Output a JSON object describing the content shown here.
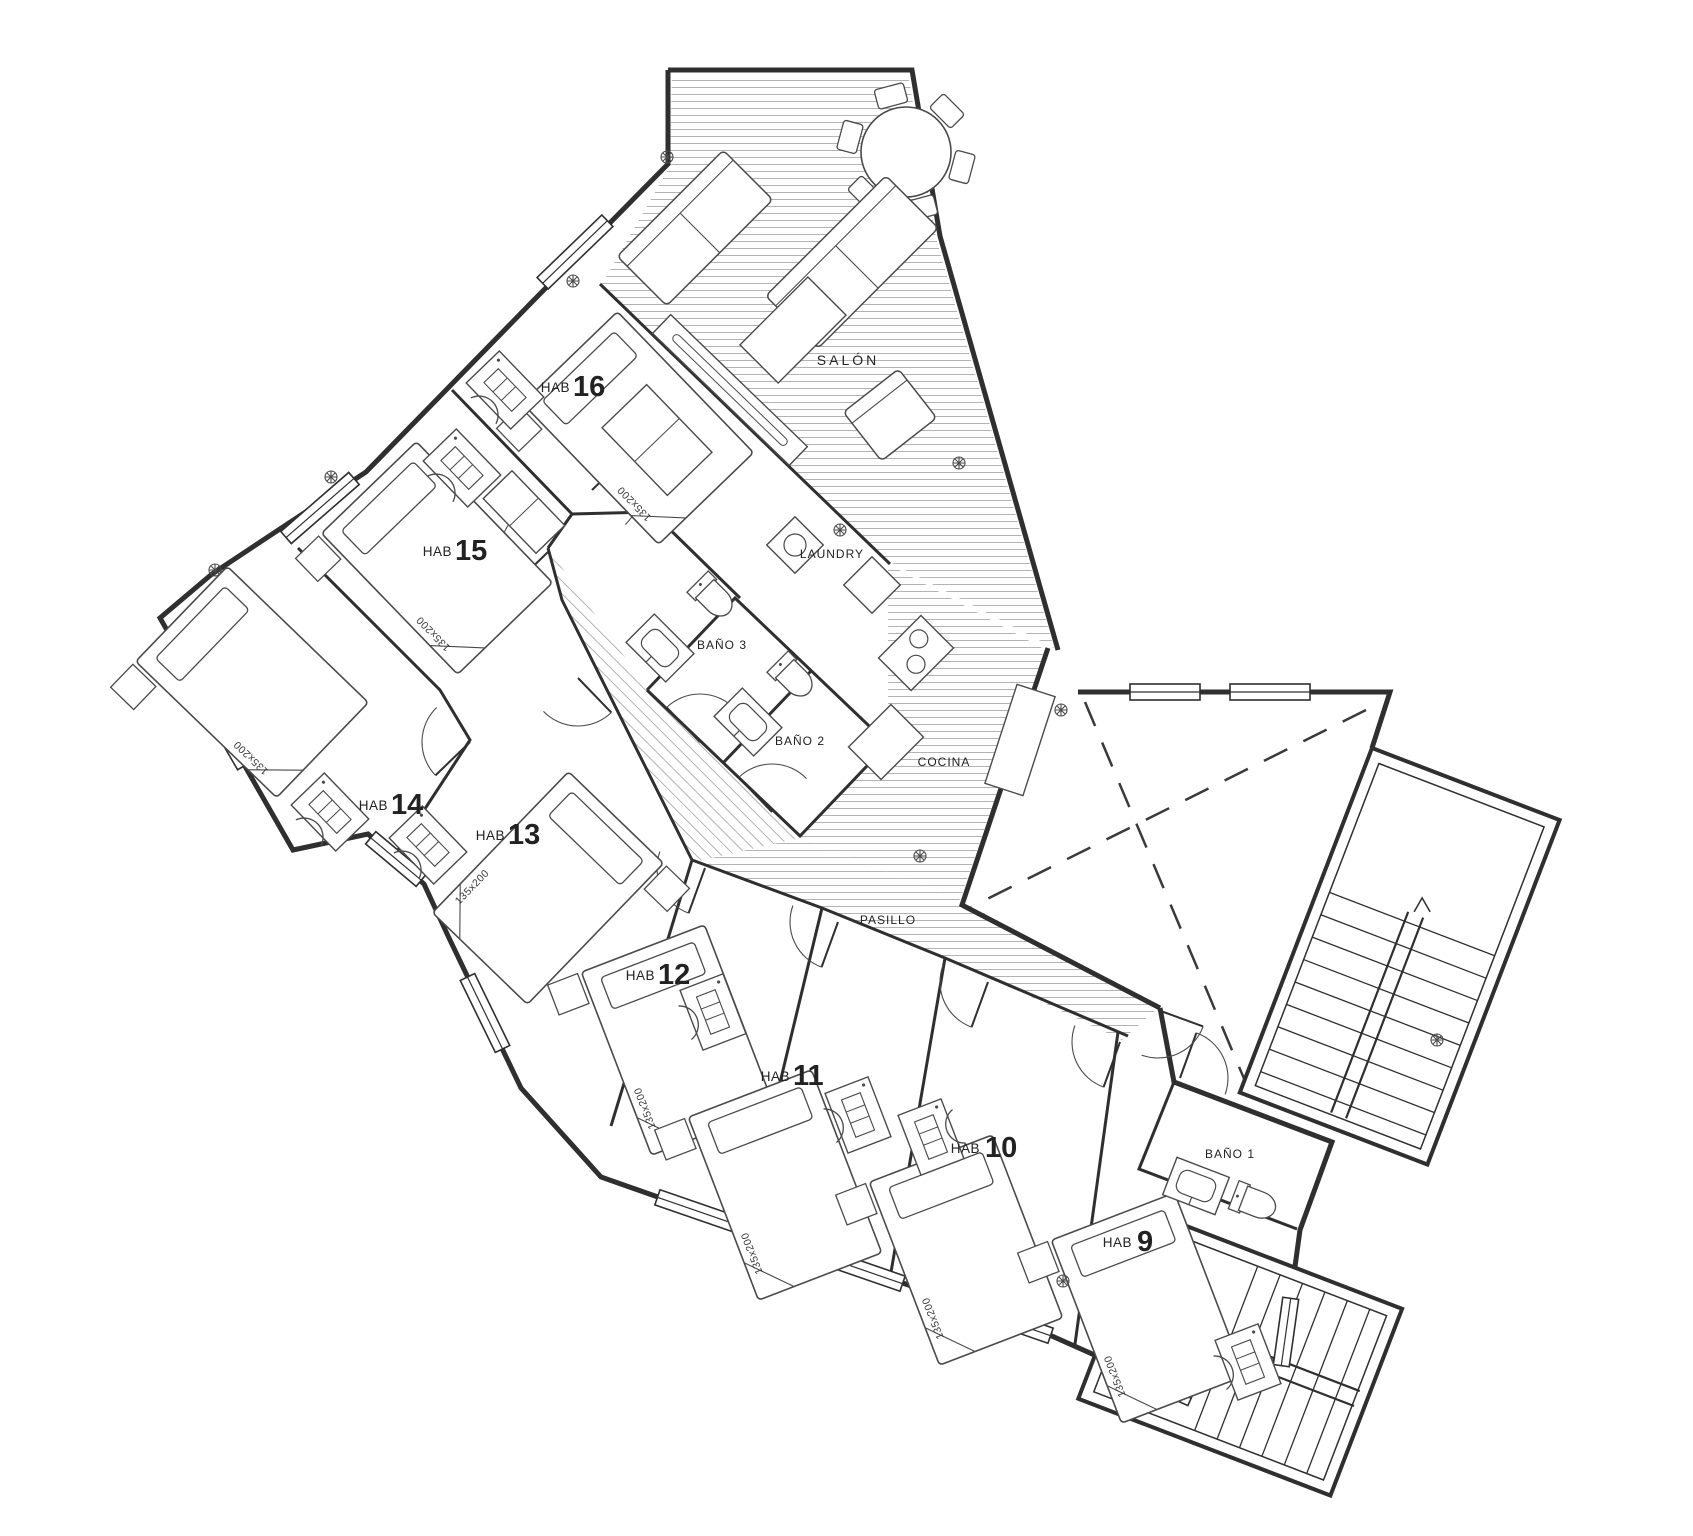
{
  "plan": {
    "zones": {
      "salon": "SALÓN",
      "laundry": "LAUNDRY",
      "cocina": "COCINA",
      "pasillo": "PASILLO",
      "bano1": "BAÑO 1",
      "bano2": "BAÑO 2",
      "bano3": "BAÑO 3"
    },
    "rooms": [
      {
        "prefix": "HAB",
        "number": "16"
      },
      {
        "prefix": "HAB",
        "number": "15"
      },
      {
        "prefix": "HAB",
        "number": "14"
      },
      {
        "prefix": "HAB",
        "number": "13"
      },
      {
        "prefix": "HAB",
        "number": "12"
      },
      {
        "prefix": "HAB",
        "number": "11"
      },
      {
        "prefix": "HAB",
        "number": "10"
      },
      {
        "prefix": "HAB",
        "number": "9"
      }
    ],
    "bed_size": "135x200",
    "colors": {
      "wall": "#2f2f2f",
      "hatch": "#b3b3b3",
      "text": "#222222",
      "background": "#ffffff",
      "fixture": "#4a4a4a"
    }
  }
}
